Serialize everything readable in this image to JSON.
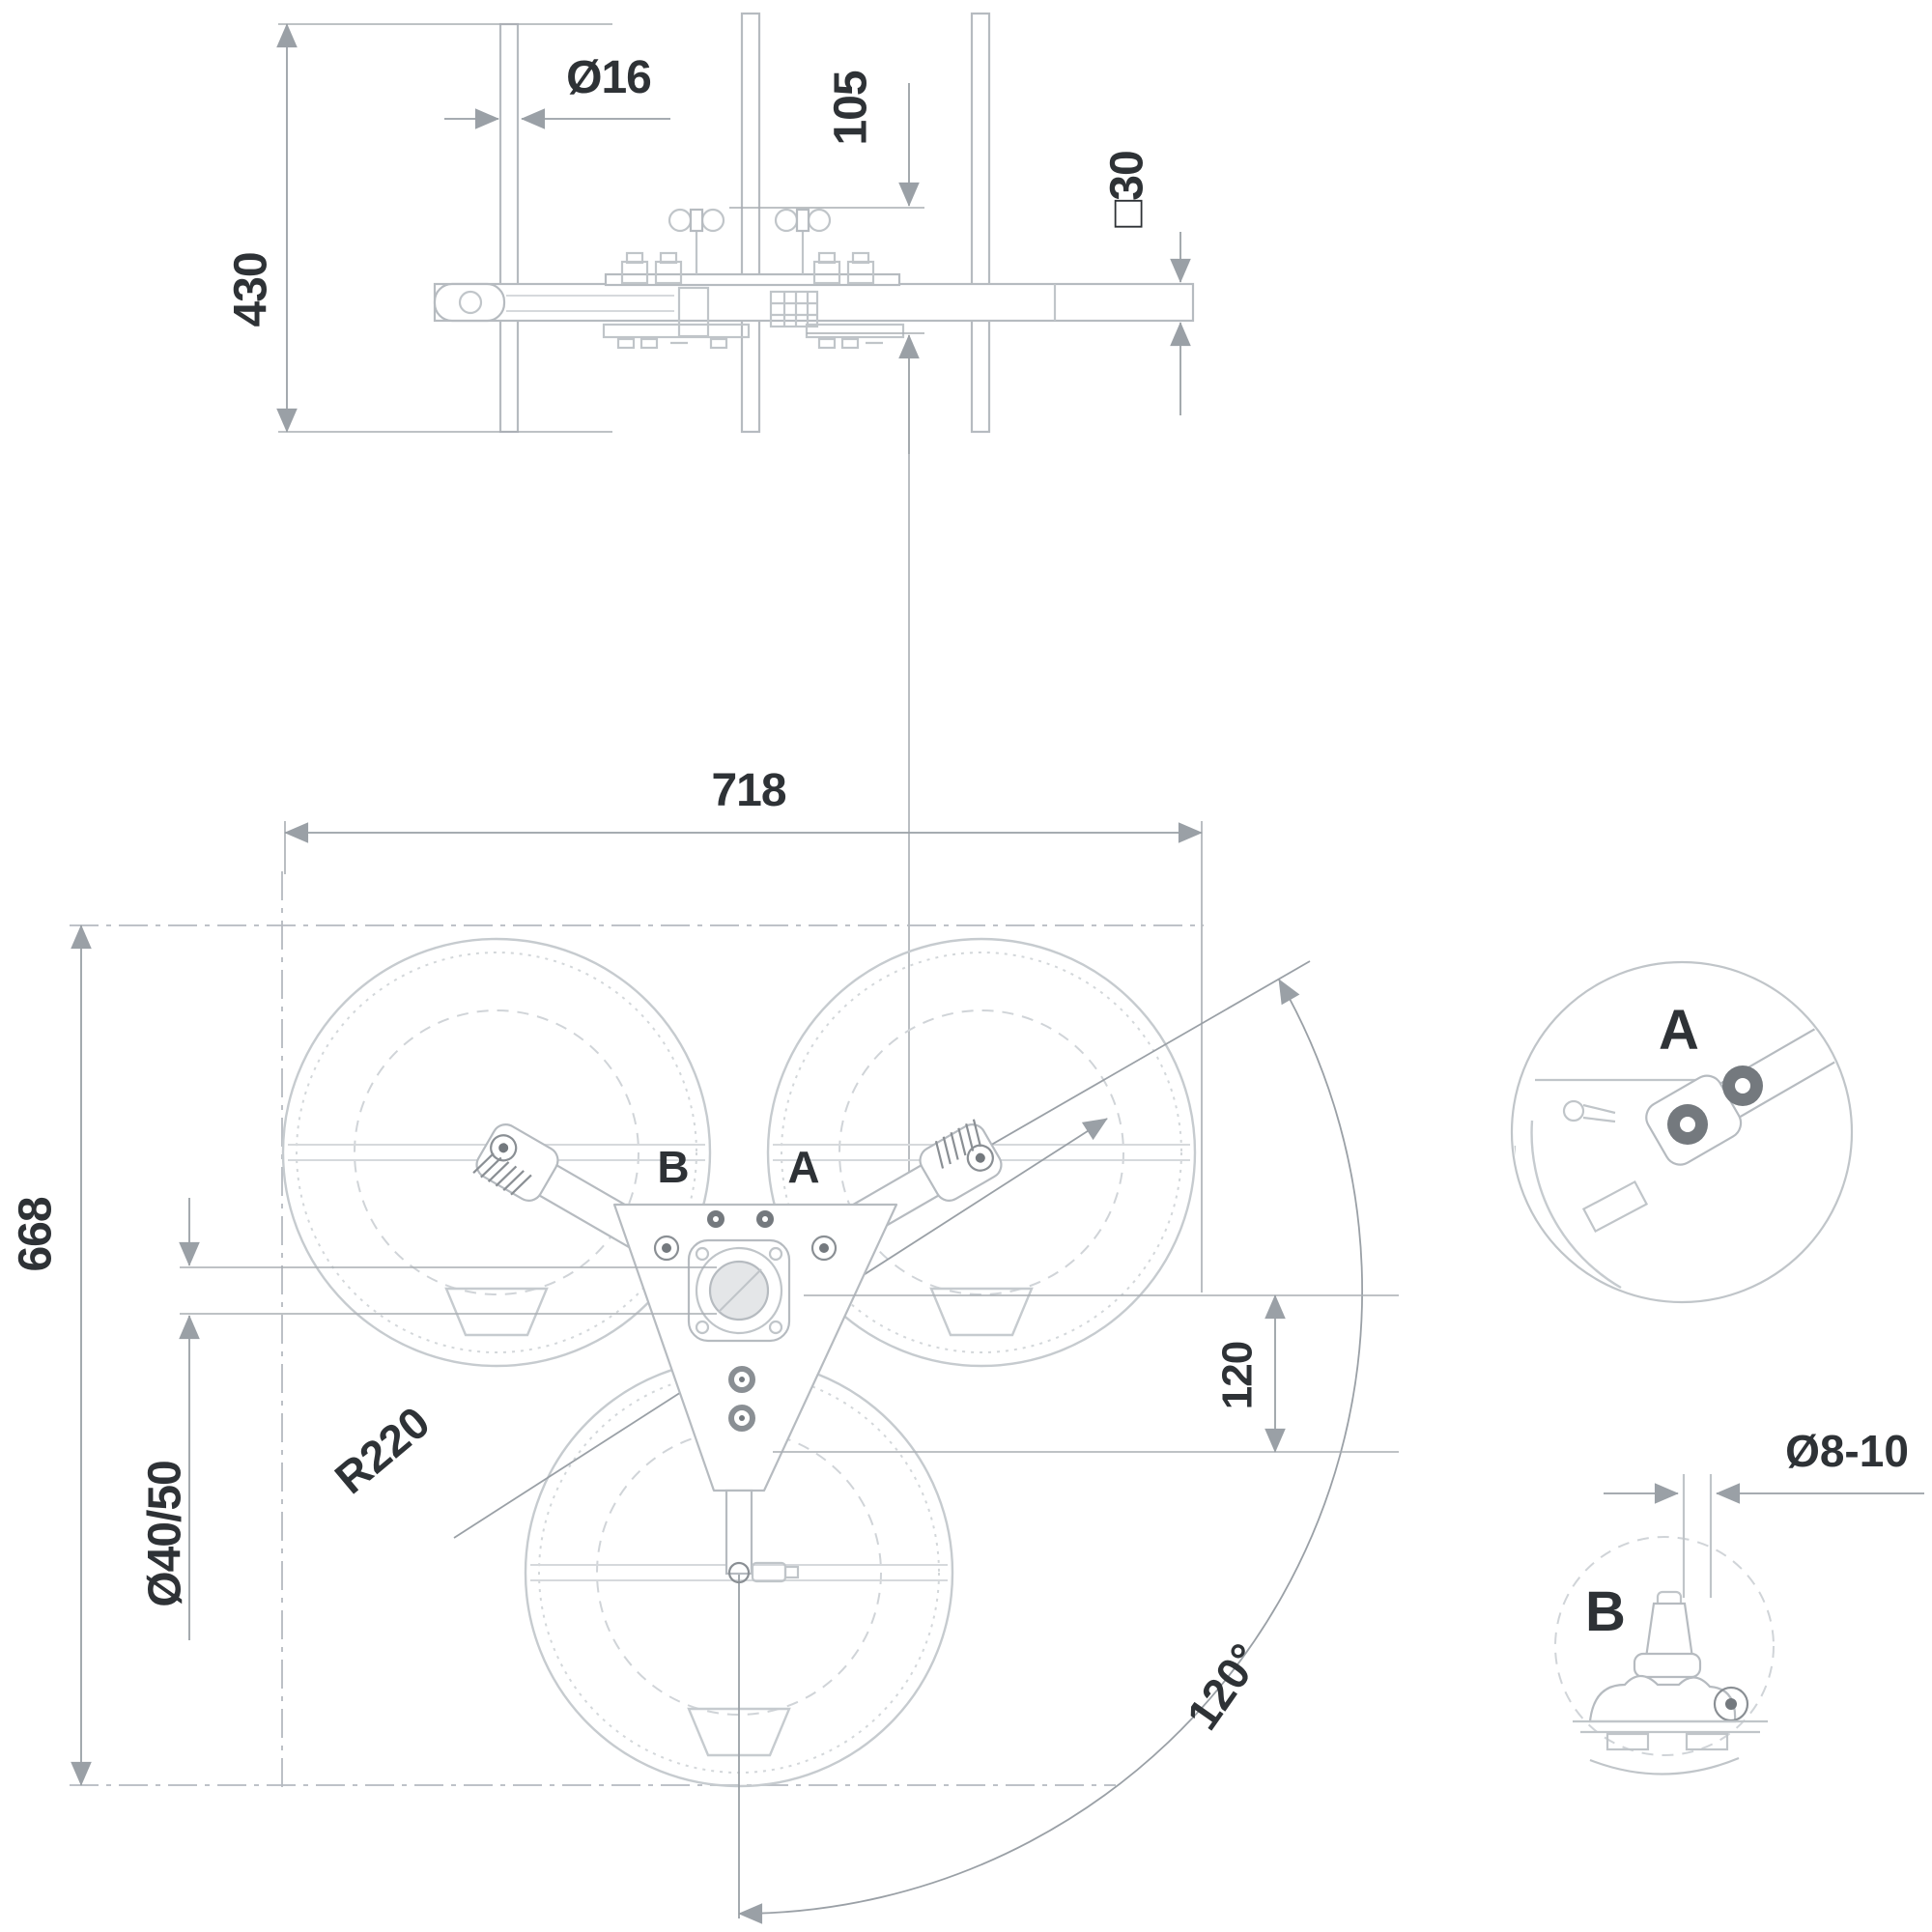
{
  "title": "Technical drawing – three-reel holder, side view and plan view with detail callouts",
  "colors": {
    "background": "#ffffff",
    "geometry_line": "#c0c5c9",
    "dimension_line": "#9aa0a6",
    "text": "#2e3236",
    "dark_fill": "#74797e"
  },
  "side_view": {
    "dim_height": "430",
    "dim_rod_diameter": "Ø16",
    "dim_offset": "105",
    "dim_bar_square": "□30"
  },
  "plan_view": {
    "dim_width": "718",
    "dim_height": "668",
    "dim_pole_diameter": "Ø40/50",
    "dim_radius": "R220",
    "dim_spacing": "120",
    "dim_angle": "120°",
    "label_detail_a": "A",
    "label_detail_b": "B"
  },
  "detail_a": {
    "label": "A"
  },
  "detail_b": {
    "label": "B",
    "dim_hole_diameter": "Ø8-10"
  }
}
